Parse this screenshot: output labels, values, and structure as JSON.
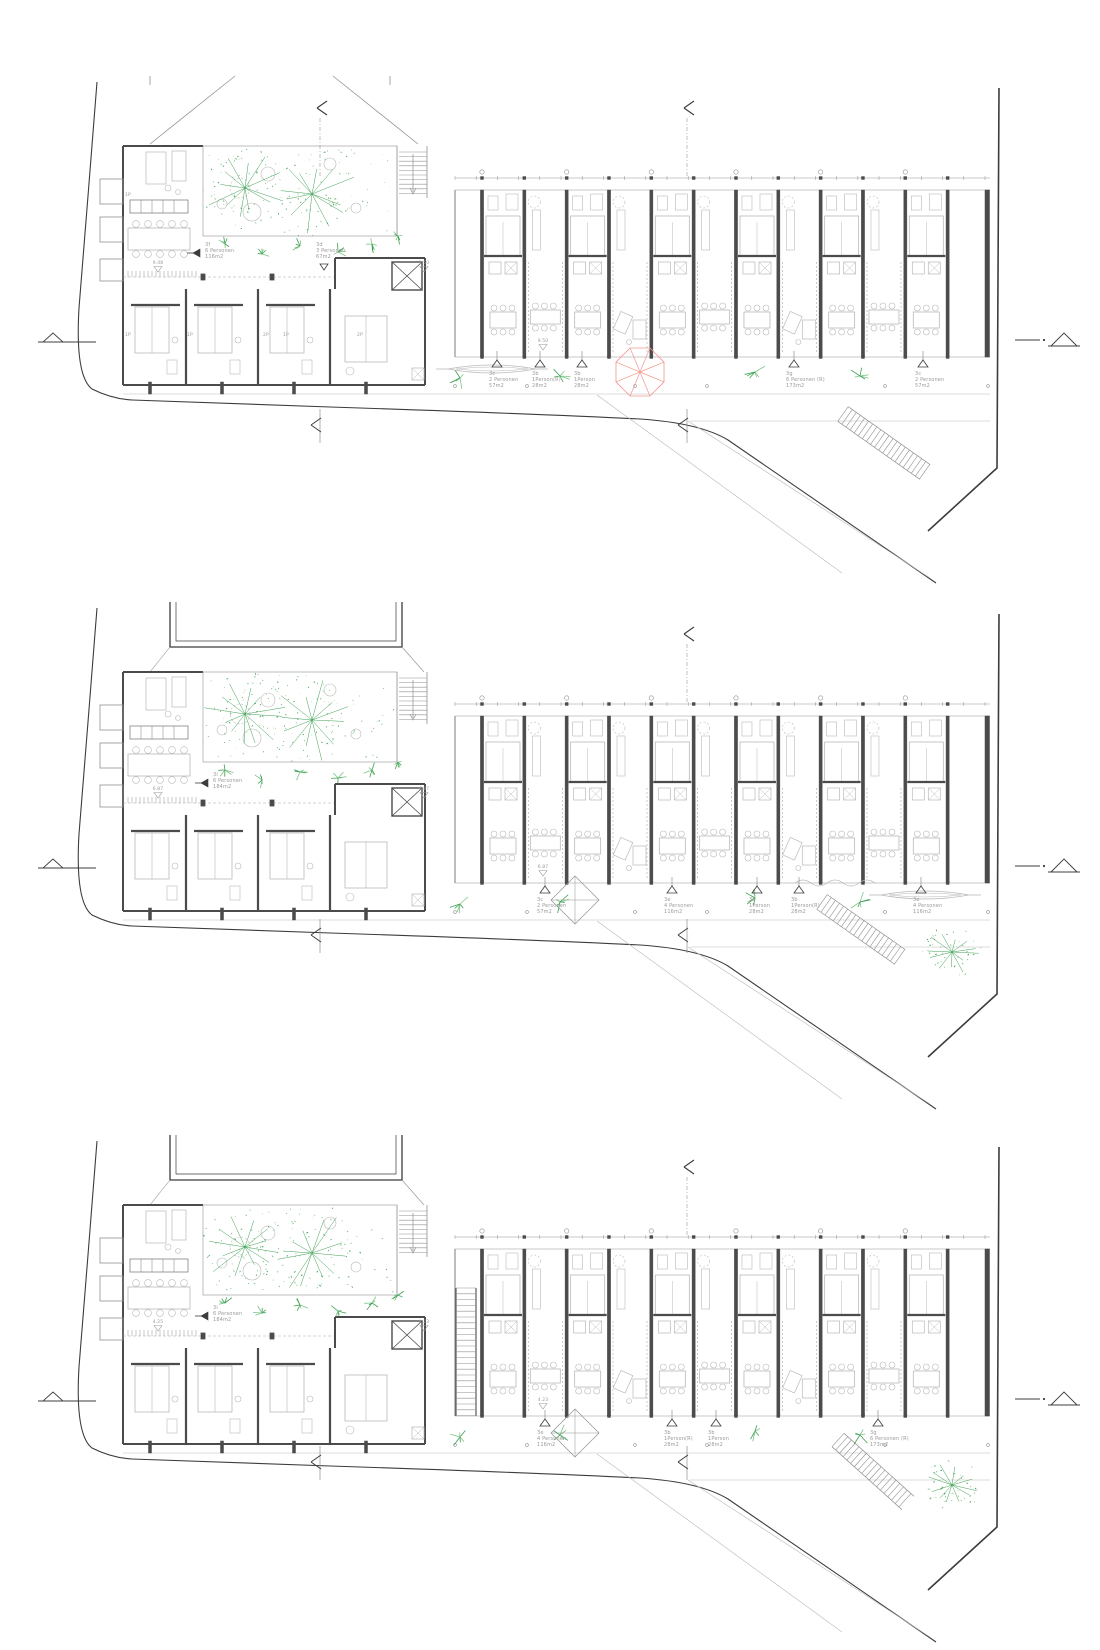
{
  "document": {
    "type": "architectural floor plans",
    "sheets": 3
  },
  "colors": {
    "line_dark": "#3c3c3c",
    "wall": "#4b4b4b",
    "light": "#b9b9b9",
    "mid": "#919191",
    "dash": "#a8a8a8",
    "green": "#3da052",
    "green_light": "#7cc488",
    "red": "#f2968f",
    "text": "#9a9a9a"
  },
  "plans": [
    {
      "id": "top",
      "neighbor": "roof",
      "elev_left": "9.48",
      "elev_right": "9.50",
      "elev_slab": "9.50",
      "left_units": [
        {
          "code": "3f",
          "occupancy": "6 Personen",
          "area": "116m2",
          "x": 205,
          "y": 170,
          "marker": "arrow"
        },
        {
          "code": "3d",
          "occupancy": "3 Personen",
          "area": "67m2",
          "x": 316,
          "y": 170,
          "marker": "tri"
        }
      ],
      "slab_units": [
        {
          "code": "3c",
          "occupancy": "2 Personen",
          "area": "57m2",
          "x": 489
        },
        {
          "code": "3b",
          "occupancy": "1Person(R)",
          "area": "28m2",
          "x": 532
        },
        {
          "code": "3b",
          "occupancy": "1Person",
          "area": "28m2",
          "x": 574
        },
        {
          "code": "3g",
          "occupancy": "6 Personen (R)",
          "area": "173m2",
          "x": 786
        },
        {
          "code": "3c",
          "occupancy": "2 Personen",
          "area": "57m2",
          "x": 915
        }
      ],
      "room_tags": [
        {
          "t": "1P",
          "x": 128,
          "y": 120
        },
        {
          "t": "1P",
          "x": 128,
          "y": 260
        },
        {
          "t": "1P",
          "x": 190,
          "y": 260
        },
        {
          "t": "2P",
          "x": 266,
          "y": 260
        },
        {
          "t": "1P",
          "x": 286,
          "y": 260
        },
        {
          "t": "2P",
          "x": 360,
          "y": 260
        }
      ],
      "features": {
        "umbrella": true,
        "hammocks": [
          492
        ],
        "sandbox": false,
        "squiggle": false,
        "big_tree": false,
        "ext_stair": false,
        "top_arrows": [
          320,
          687
        ],
        "ladder": {
          "x1": 843,
          "y1": 338,
          "x2": 925,
          "y2": 396
        },
        "bottom_arrow_y": 349
      }
    },
    {
      "id": "middle",
      "neighbor": "outline",
      "elev_left": "6.87",
      "elev_right": "6.87",
      "elev_slab": "6.87",
      "left_units": [
        {
          "code": "3i",
          "occupancy": "6 Personen",
          "area": "184m2",
          "x": 213,
          "y": 174,
          "marker": "arrow"
        }
      ],
      "slab_units": [
        {
          "code": "3c",
          "occupancy": "2 Personen",
          "area": "57m2",
          "x": 537
        },
        {
          "code": "3e",
          "occupancy": "4 Personen",
          "area": "116m2",
          "x": 664
        },
        {
          "code": "3b",
          "occupancy": "1Person",
          "area": "28m2",
          "x": 749
        },
        {
          "code": "3b",
          "occupancy": "1Person(R)",
          "area": "28m2",
          "x": 791
        },
        {
          "code": "3e",
          "occupancy": "4 Personen",
          "area": "116m2",
          "x": 913
        }
      ],
      "room_tags": [],
      "features": {
        "umbrella": false,
        "hammocks": [
          925
        ],
        "sandbox": true,
        "squiggle": true,
        "big_tree": true,
        "ext_stair": false,
        "top_arrows": [
          687
        ],
        "ladder": {
          "x1": 822,
          "y1": 300,
          "x2": 900,
          "y2": 355
        },
        "bottom_arrow_y": 333
      }
    },
    {
      "id": "bottom",
      "neighbor": "outline",
      "elev_left": "4.25",
      "elev_right": "4.23",
      "elev_slab": "4.23",
      "left_units": [
        {
          "code": "3i",
          "occupancy": "6 Personen",
          "area": "184m2",
          "x": 213,
          "y": 174,
          "marker": "arrow"
        }
      ],
      "slab_units": [
        {
          "code": "3e",
          "occupancy": "4 Personen",
          "area": "116m2",
          "x": 537
        },
        {
          "code": "3b",
          "occupancy": "1Person(R)",
          "area": "28m2",
          "x": 664
        },
        {
          "code": "3b",
          "occupancy": "1Person",
          "area": "28m2",
          "x": 708
        },
        {
          "code": "3g",
          "occupancy": "6 Personen (R)",
          "area": "173m2",
          "x": 870
        }
      ],
      "room_tags": [],
      "features": {
        "umbrella": false,
        "hammocks": [],
        "sandbox": true,
        "squiggle": false,
        "big_tree": true,
        "ext_stair": true,
        "top_arrows": [
          687
        ],
        "ladder": {
          "x1": 838,
          "y1": 305,
          "x2": 908,
          "y2": 368
        },
        "bottom_arrow_y": 327
      }
    }
  ]
}
